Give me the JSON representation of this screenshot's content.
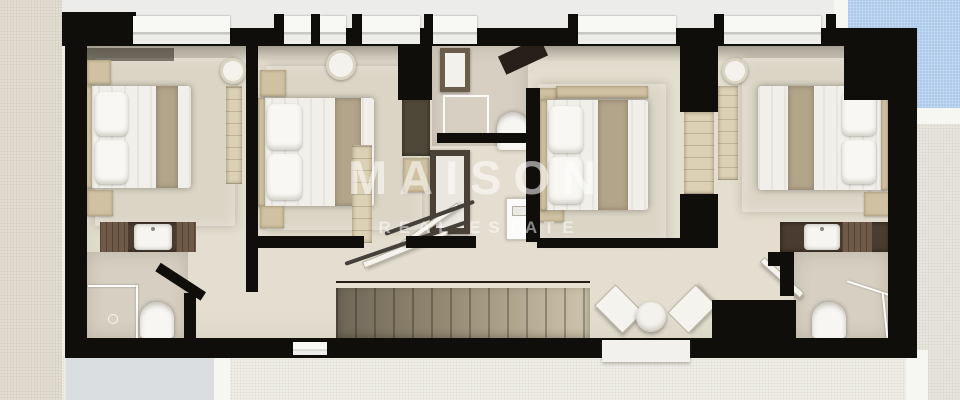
{
  "watermark": {
    "brand": "MAISON",
    "tagline": "REAL ESTATE"
  },
  "scene": {
    "kind": "top-down 3d floor plan render",
    "level": "bedroom floor with central staircase",
    "surroundings": [
      "stucco-wall-left",
      "swimming-pool-top-right",
      "pool-deck",
      "terrace-bottom"
    ]
  },
  "palette": {
    "walls": "#0f0e0b",
    "floor": "#e3decf",
    "bathroom_floor": "#d7d0c2",
    "wood": "#cfc1a1",
    "bed_runner": "#b2a58a",
    "counter": "#4a3c30",
    "pool": "#a9c7e9",
    "stucco": "#e6e1d5",
    "terrace": "#f1f0ea",
    "watermark": "rgba(255,255,255,0.55)"
  },
  "rooms": [
    {
      "id": "bedroom-1",
      "furniture": [
        "double-bed",
        "pillows",
        "bed-runner",
        "nightstand",
        "nightstand",
        "wardrobe",
        "round-mirror",
        "vanity-sink",
        "rug"
      ]
    },
    {
      "id": "bedroom-2",
      "furniture": [
        "double-bed",
        "pillows",
        "bed-runner",
        "nightstand",
        "nightstand",
        "round-mirror",
        "wardrobe",
        "rug"
      ]
    },
    {
      "id": "bedroom-3",
      "furniture": [
        "double-bed",
        "pillows",
        "bed-runner",
        "nightstand",
        "wall-shelf",
        "rug"
      ]
    },
    {
      "id": "bedroom-4",
      "furniture": [
        "double-bed",
        "pillows",
        "bed-runner",
        "nightstand",
        "wardrobe",
        "round-mirror",
        "vanity-sink",
        "rug"
      ]
    },
    {
      "id": "bathroom-1",
      "furniture": [
        "walk-in-shower",
        "toilet",
        "vanity-sink"
      ]
    },
    {
      "id": "bathroom-2",
      "furniture": [
        "walk-in-shower",
        "toilet",
        "mirror-cabinet",
        "washing-machine",
        "cabinet"
      ]
    },
    {
      "id": "bathroom-3",
      "furniture": [
        "walk-in-shower",
        "toilet",
        "vanity-sink",
        "open-door"
      ]
    },
    {
      "id": "hallway",
      "furniture": [
        "staircase",
        "glass-railing",
        "open-door-panels",
        "round-pouf",
        "entry-step"
      ]
    }
  ]
}
